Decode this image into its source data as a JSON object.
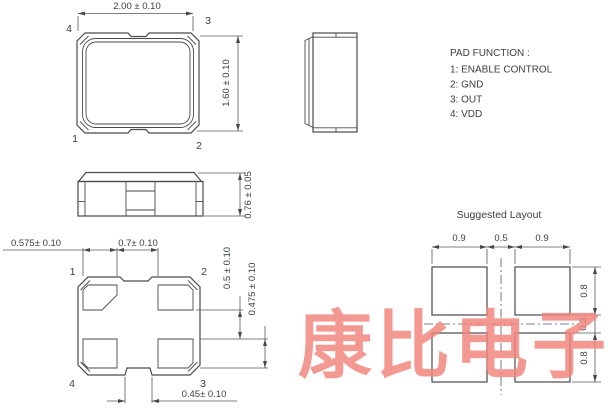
{
  "pad_function": {
    "title": "PAD FUNCTION :",
    "items": [
      "1: ENABLE CONTROL",
      "2: GND",
      "3: OUT",
      "4: VDD"
    ]
  },
  "top_view": {
    "pin_top_left": "4",
    "pin_top_right": "3",
    "pin_bottom_left": "1",
    "pin_bottom_right": "2",
    "dim_width": "2.00 ± 0.10",
    "dim_height": "1.60 ± 0.10"
  },
  "front_view": {
    "dim_height": "0.76 ± 0.05"
  },
  "bottom_view": {
    "pin_top_left": "1",
    "pin_top_right": "2",
    "pin_bottom_left": "4",
    "pin_bottom_right": "3",
    "dim_pad_width": "0.575± 0.10",
    "dim_pad_gap": "0.7± 0.10",
    "dim_vertical_gap": "0.5 ± 0.10",
    "dim_pad_height": "0.475 ± 0.10",
    "dim_notch_width": "0.45± 0.10"
  },
  "suggested_layout": {
    "title": "Suggested Layout",
    "dim_left_pad_width": "0.9",
    "dim_center_gap": "0.5",
    "dim_right_pad_width": "0.9",
    "dim_top_pad_height": "0.8",
    "dim_row_gap": "0.3",
    "dim_bottom_pad_height": "0.8"
  },
  "watermark": {
    "text": "康比电子"
  },
  "colors": {
    "line": "#4a4a4d",
    "dimension": "#55585c",
    "text": "#3c4043",
    "watermark": "#f2837b"
  }
}
